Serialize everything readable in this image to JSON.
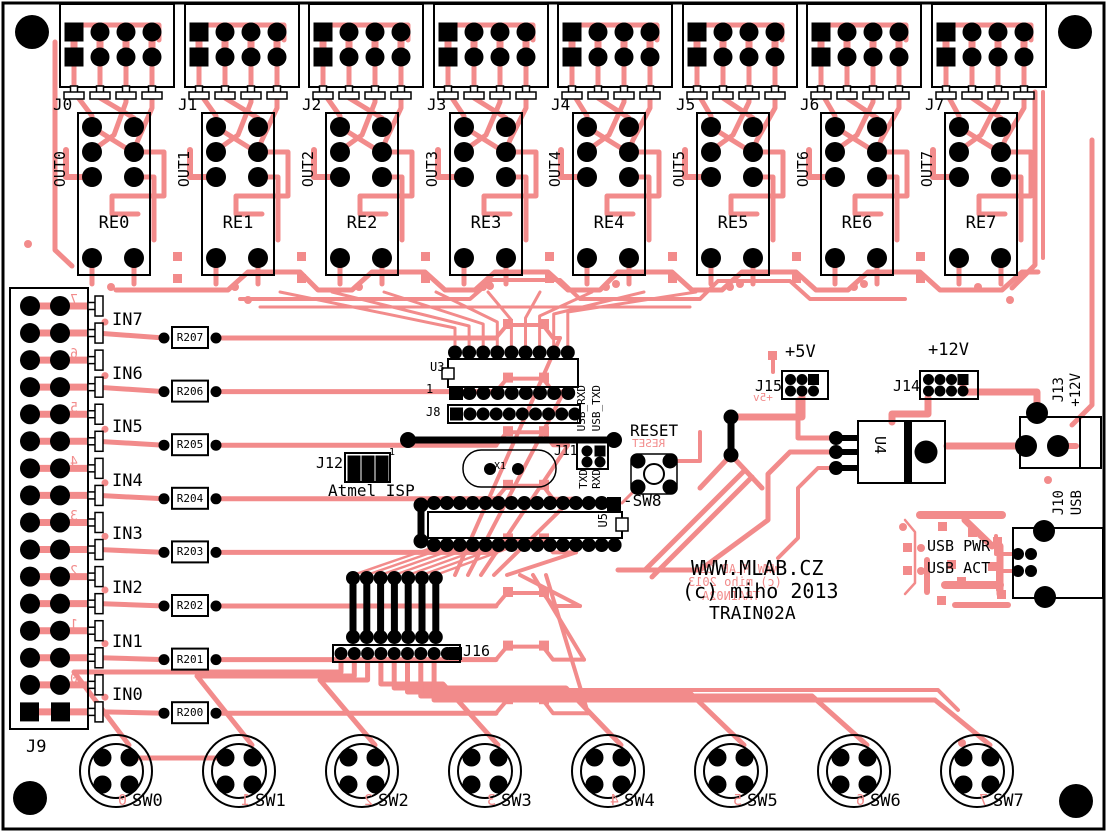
{
  "board": {
    "copyright": {
      "line1": "WWW.MLAB.CZ",
      "line2": "(c) miho 2013",
      "line3": "TRAIN02A"
    },
    "copyright_mirror": {
      "line1": "WWW.MLAB.CZ",
      "line2": "(c) miho 2013",
      "line3": "TRAIN02A"
    },
    "colors": {
      "trace": "#f28b8b",
      "silkscreen": "#000000",
      "board": "#ffffff"
    }
  },
  "relay_channels": [
    {
      "connector": "J0",
      "output": "OUT0",
      "relay": "RE0"
    },
    {
      "connector": "J1",
      "output": "OUT1",
      "relay": "RE1"
    },
    {
      "connector": "J2",
      "output": "OUT2",
      "relay": "RE2"
    },
    {
      "connector": "J3",
      "output": "OUT3",
      "relay": "RE3"
    },
    {
      "connector": "J4",
      "output": "OUT4",
      "relay": "RE4"
    },
    {
      "connector": "J5",
      "output": "OUT5",
      "relay": "RE5"
    },
    {
      "connector": "J6",
      "output": "OUT6",
      "relay": "RE6"
    },
    {
      "connector": "J7",
      "output": "OUT7",
      "relay": "RE7"
    }
  ],
  "input_section": {
    "connector_label": "J9",
    "channels": [
      {
        "label": "IN7",
        "resistor": "R207",
        "mirror_digit": "7"
      },
      {
        "label": "IN6",
        "resistor": "R206",
        "mirror_digit": "6"
      },
      {
        "label": "IN5",
        "resistor": "R205",
        "mirror_digit": "5"
      },
      {
        "label": "IN4",
        "resistor": "R204",
        "mirror_digit": "4"
      },
      {
        "label": "IN3",
        "resistor": "R203",
        "mirror_digit": "3"
      },
      {
        "label": "IN2",
        "resistor": "R202",
        "mirror_digit": "2"
      },
      {
        "label": "IN1",
        "resistor": "R201",
        "mirror_digit": "1"
      },
      {
        "label": "IN0",
        "resistor": "R200",
        "mirror_digit": "0"
      }
    ]
  },
  "switches": [
    {
      "label": "SW0",
      "mirror_digit": "0"
    },
    {
      "label": "SW1",
      "mirror_digit": "1"
    },
    {
      "label": "SW2",
      "mirror_digit": "2"
    },
    {
      "label": "SW3",
      "mirror_digit": "3"
    },
    {
      "label": "SW4",
      "mirror_digit": "4"
    },
    {
      "label": "SW5",
      "mirror_digit": "5"
    },
    {
      "label": "SW6",
      "mirror_digit": "6"
    },
    {
      "label": "SW7",
      "mirror_digit": "7"
    }
  ],
  "mcu_section": {
    "u3": "U3",
    "u3_pin1": "1",
    "j8": "J8",
    "usb_rxd": "USB_RXD",
    "usb_txd": "USB_TXD",
    "j11": "J11",
    "txd": "TXD",
    "rxd": "RXD",
    "reset": "RESET",
    "reset_mirror": "RESET",
    "sw8": "-SW8",
    "x1": "X1",
    "u5": "U5",
    "j12": "J12",
    "j12_pin1": "1",
    "isp": "Atmel ISP",
    "j16": "J16"
  },
  "power_section": {
    "p5v": "+5V",
    "p5v_mirror": "+5v",
    "j15": "J15",
    "p12v": "+12V",
    "j14": "J14",
    "u4": "U4",
    "j13": "J13",
    "j13_voltage": "+12V",
    "j10": "J10",
    "j10_type": "USB",
    "usb_pwr": "USB PWR",
    "usb_act": "USB ACT"
  }
}
